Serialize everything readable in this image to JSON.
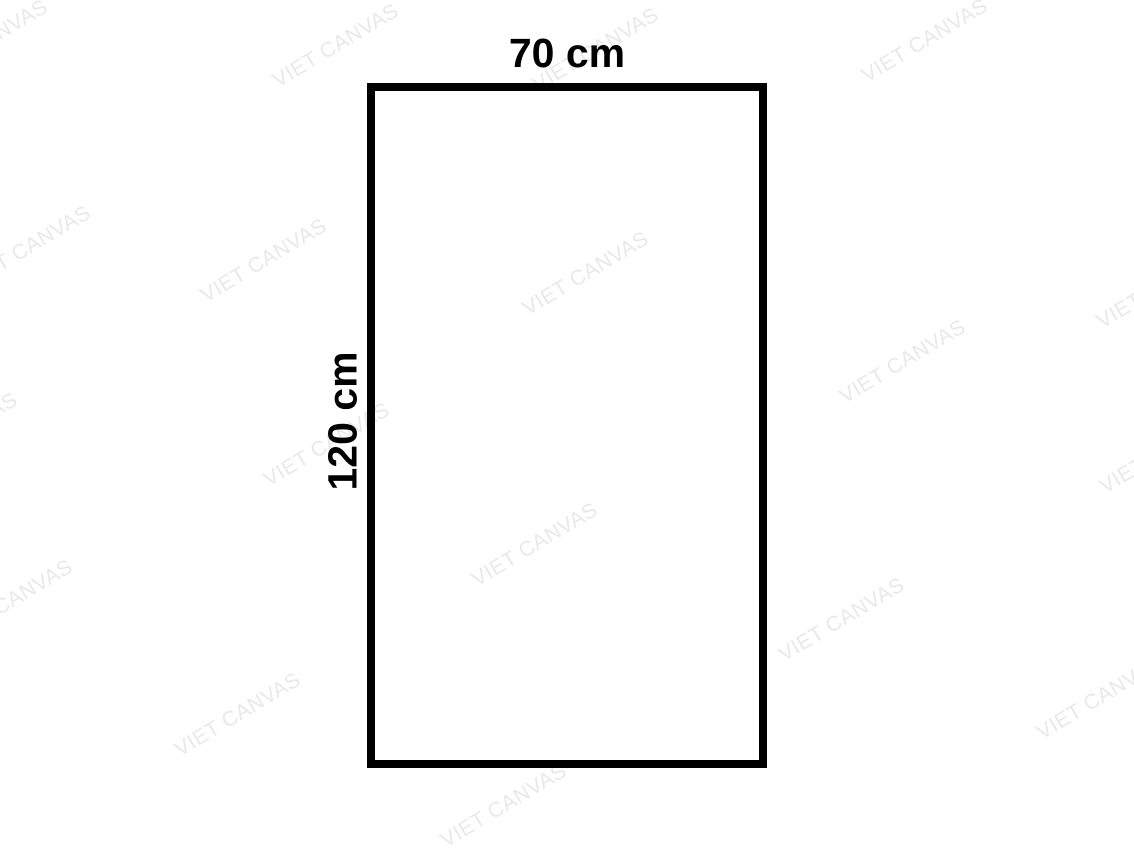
{
  "diagram": {
    "width_label": "70 cm",
    "height_label": "120 cm"
  },
  "shape": {
    "left": 367,
    "top": 83,
    "width": 400,
    "height": 685,
    "border_px": 8
  },
  "colors": {
    "background": "#ffffff",
    "shape_border": "#000000",
    "label_text": "#000000",
    "watermark": "#e9e9e9"
  },
  "watermark": {
    "text": "VIET CANVAS",
    "angle_deg": -31,
    "positions": [
      {
        "x": -15,
        "y": 42
      },
      {
        "x": 336,
        "y": 46
      },
      {
        "x": 596,
        "y": 50
      },
      {
        "x": 925,
        "y": 41
      },
      {
        "x": 28,
        "y": 248
      },
      {
        "x": 264,
        "y": 261
      },
      {
        "x": 586,
        "y": 274
      },
      {
        "x": 1160,
        "y": 287
      },
      {
        "x": 903,
        "y": 362
      },
      {
        "x": 327,
        "y": 445
      },
      {
        "x": 1163,
        "y": 452
      },
      {
        "x": -45,
        "y": 435
      },
      {
        "x": 10,
        "y": 602
      },
      {
        "x": 238,
        "y": 715
      },
      {
        "x": 535,
        "y": 545
      },
      {
        "x": 842,
        "y": 620
      },
      {
        "x": 1100,
        "y": 698
      },
      {
        "x": 504,
        "y": 806
      }
    ]
  }
}
